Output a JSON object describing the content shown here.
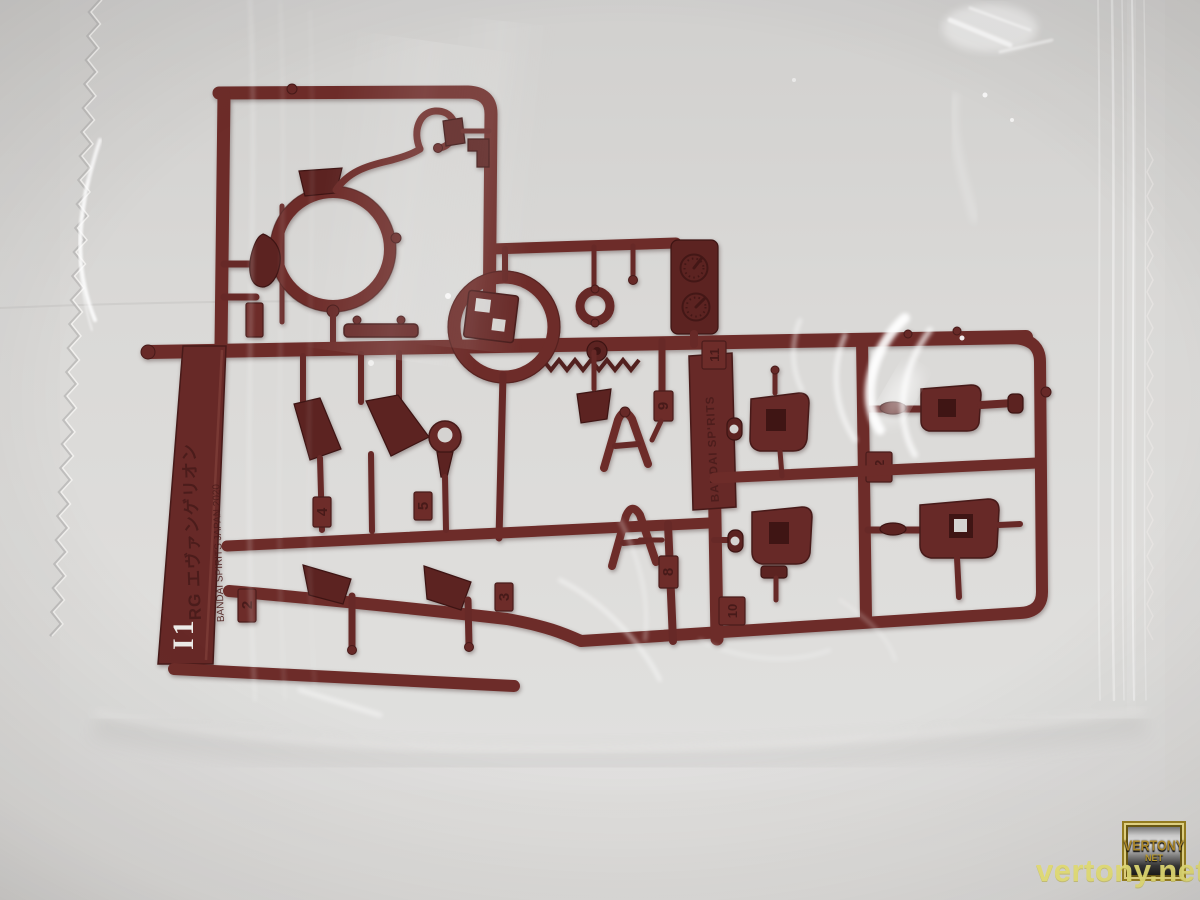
{
  "sprue": {
    "runner_code": "I1",
    "brand_main": "RG エヴァンゲリオン",
    "brand_sub": "BANDAI SPIRITS JAPAN 2020",
    "side_plate": "BANDAI SPIRITS",
    "gate_numbers": [
      "2",
      "3",
      "4",
      "5",
      "8",
      "9",
      "10",
      "11",
      "12"
    ],
    "plastic_color": "#6d2c29"
  },
  "watermark": {
    "site": "vertony.net",
    "badge_line1": "VERTONY",
    "badge_line2": "NET",
    "color": "#f1eb7a"
  },
  "colors": {
    "background": "#d9d8d6",
    "bag_highlight": "#ffffff"
  }
}
